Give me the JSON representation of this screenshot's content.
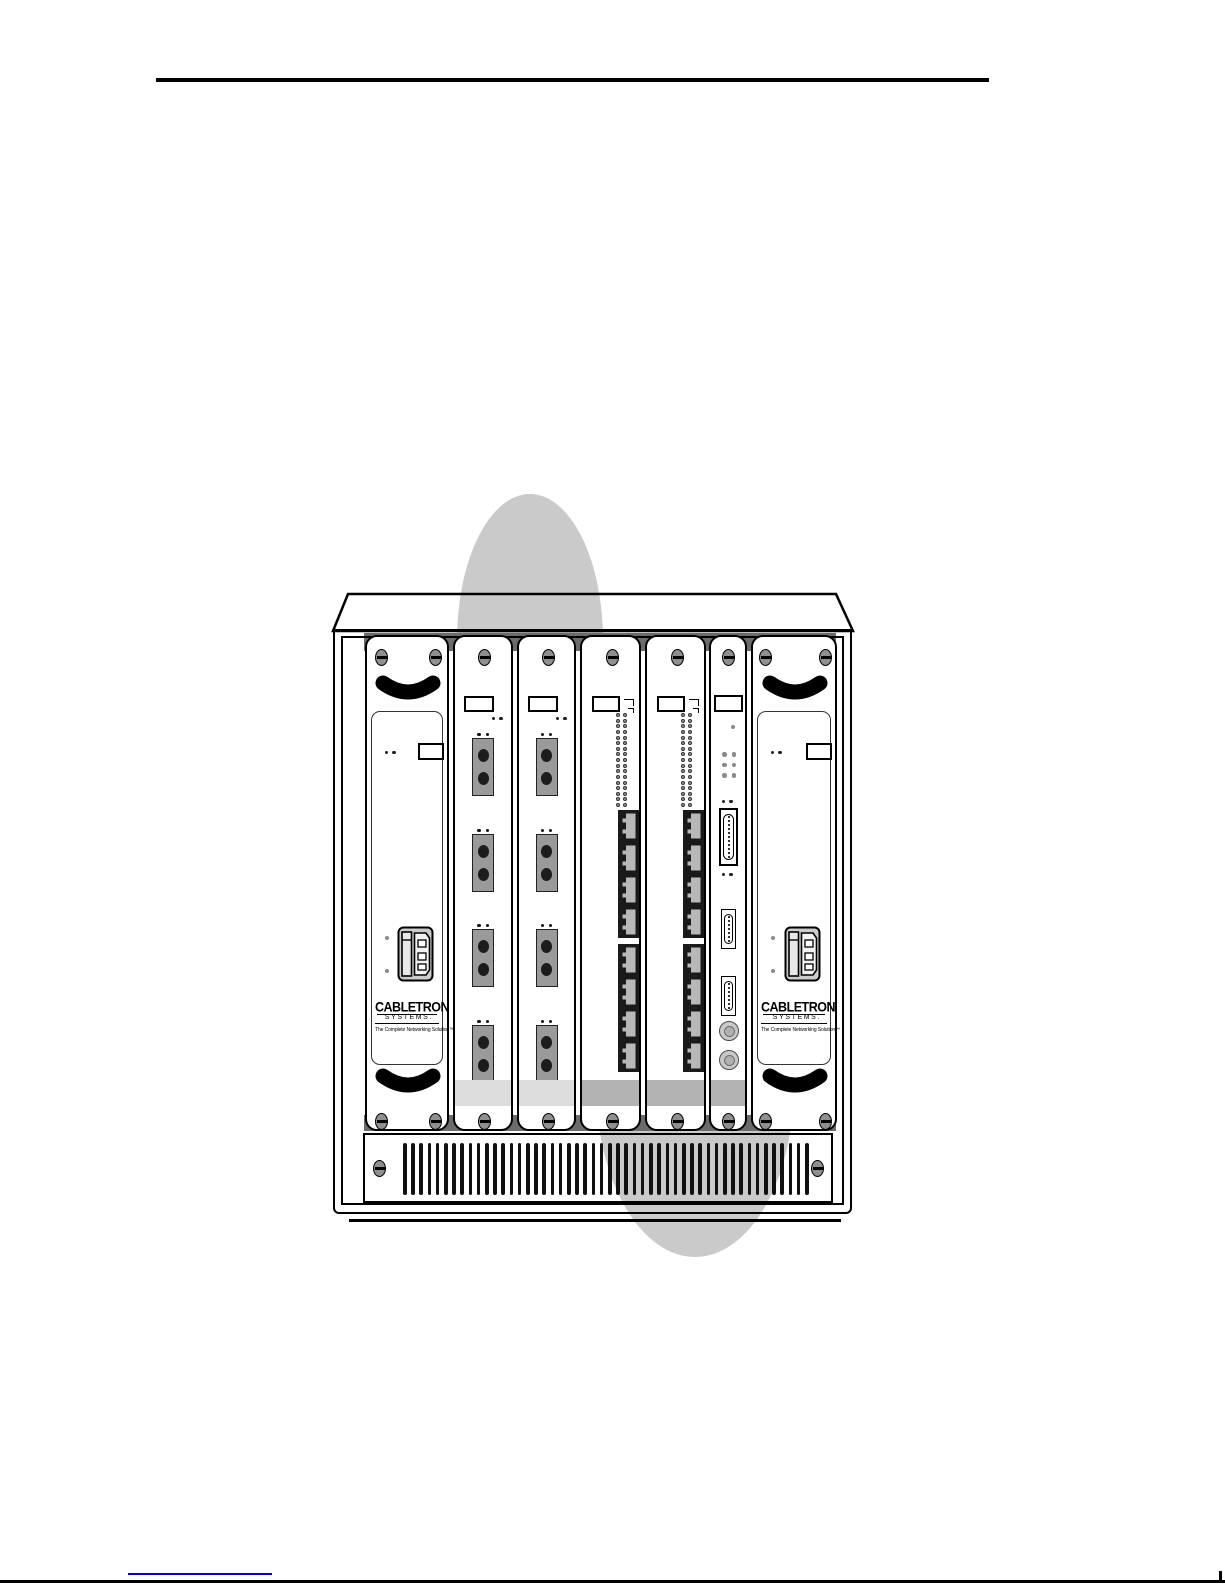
{
  "document": {
    "kind": "hardware-manual-page",
    "figure_subject": "Cabletron Systems modular hub chassis, front view"
  },
  "logo": {
    "name": "CABLETRON",
    "sub": "SYSTEMS.",
    "tagline": "The Complete Networking Solution™"
  },
  "chassis": {
    "slots": [
      {
        "slot": 1,
        "type": "power-supply"
      },
      {
        "slot": 2,
        "type": "fiber-media-module"
      },
      {
        "slot": 3,
        "type": "fiber-media-module"
      },
      {
        "slot": 4,
        "type": "twisted-pair-port-module"
      },
      {
        "slot": 5,
        "type": "twisted-pair-port-module"
      },
      {
        "slot": 6,
        "type": "management-module"
      },
      {
        "slot": 7,
        "type": "power-supply"
      }
    ],
    "vent": {
      "slot_count": 50
    }
  },
  "fiber": {
    "units_per_module": 4,
    "ports_per_unit": 2
  },
  "tp": {
    "led_rows": 17,
    "led_columns": 2,
    "jack_groups": 2,
    "jacks_per_group": 4
  },
  "mgmt": {
    "led_grid_rows": 3,
    "led_grid_columns": 2,
    "connectors": [
      "DB25",
      "DB9",
      "DB9",
      "round-connector",
      "round-connector"
    ]
  },
  "colors": {
    "watermark": "#cacaca",
    "cage": "#6b6b6b",
    "band_light": "#dcdcdc",
    "band_mid": "#b3b3b3",
    "fiber_port": "#9a9a9a",
    "screw": "#8f8f8f",
    "vent_slot": "#111111",
    "link": "#0000cc"
  }
}
